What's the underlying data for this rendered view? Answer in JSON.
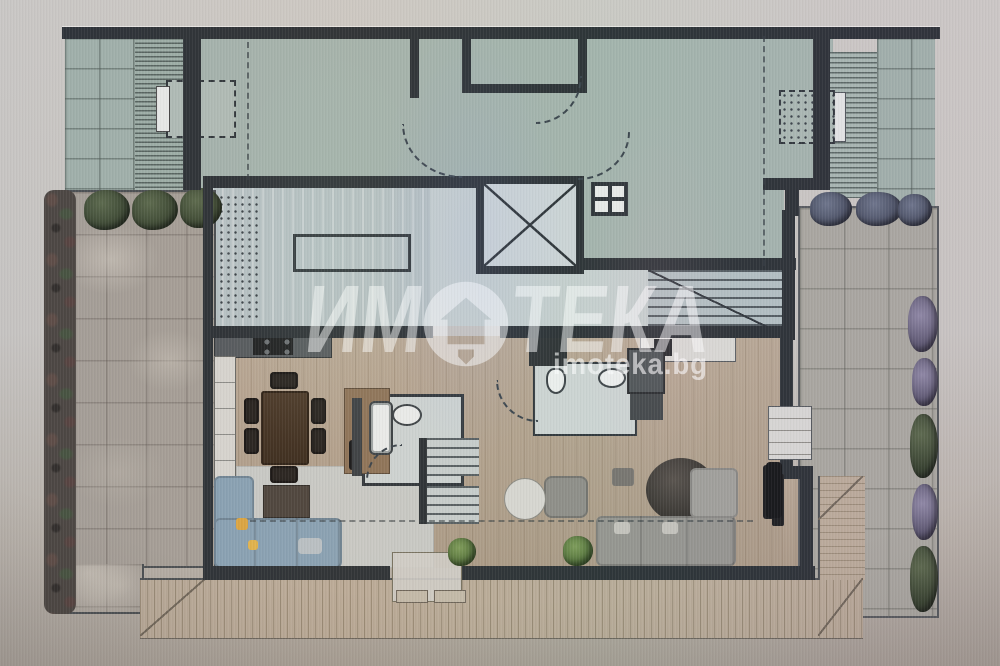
{
  "image_type": "photograph of an architectural floor plan displayed on a screen",
  "watermark": {
    "brand_left": "ИМ",
    "brand_right": "ТЕКА",
    "brand_full": "ИМОТЕКА",
    "logo": "house-in-circle",
    "domain": "imoteka.bg",
    "text_color": "#ffffff"
  },
  "plan": {
    "palette": {
      "roof_terrace_green": "#a3b2ab",
      "wall_dark": "#2b3034",
      "stone_paving": "#a49d94",
      "wood_floor": "#b3a18c",
      "deck": "#b9aa97",
      "sofa_blue": "#87a0b2",
      "sofa_gray": "#95938e",
      "rug_light": "#c9cecd",
      "dining_table_wood": "#40301f"
    },
    "features": [
      "roof-terrace",
      "paved-terrace",
      "planted-hedge",
      "skylight",
      "elevator-shaft",
      "interior-staircase",
      "dining-area",
      "kitchen",
      "bathroom",
      "living-area",
      "wood-deck",
      "door-swing-arcs"
    ]
  }
}
